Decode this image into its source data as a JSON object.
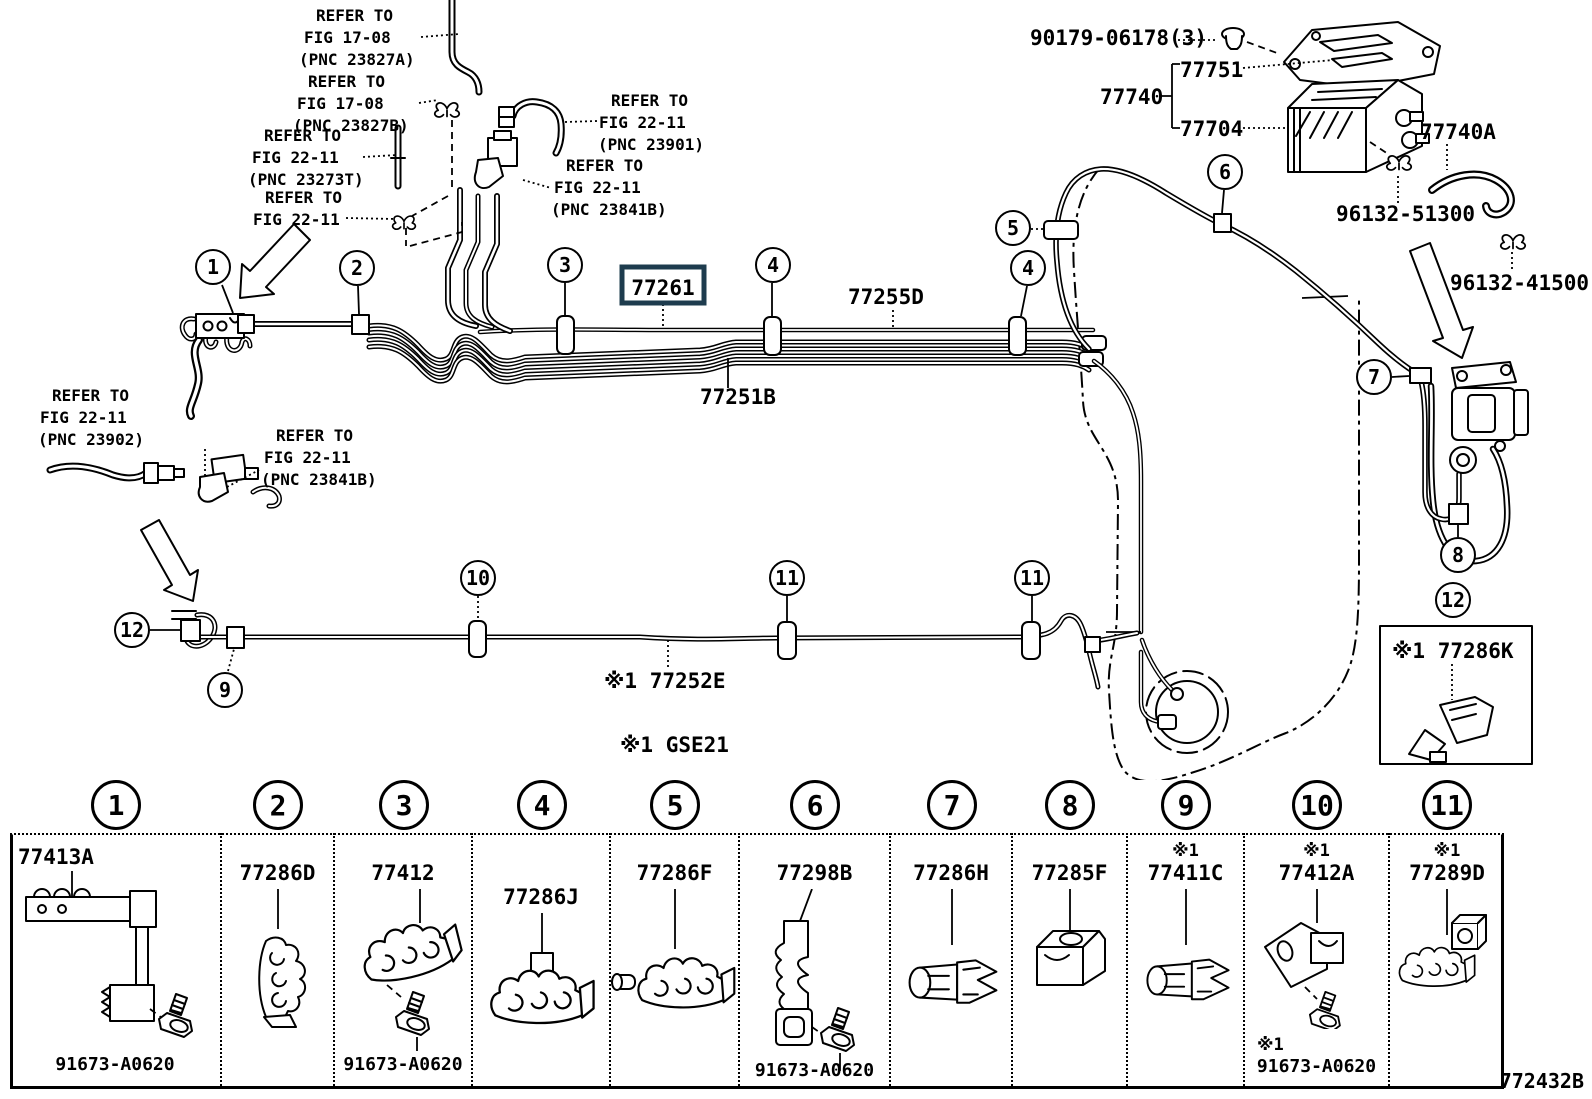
{
  "figure": {
    "code": "772432B",
    "variant_note": "※1 GSE21",
    "highlight_color": "#1e3c4e"
  },
  "refer_notes": [
    {
      "lines": [
        "REFER TO",
        "FIG 17-08",
        "(PNC 23827A)"
      ]
    },
    {
      "lines": [
        "REFER TO",
        "FIG 17-08",
        "(PNC 23827B)"
      ]
    },
    {
      "lines": [
        "REFER TO",
        "FIG 22-11",
        "(PNC 23273T)"
      ]
    },
    {
      "lines": [
        "REFER TO",
        "FIG 22-11"
      ]
    },
    {
      "lines": [
        "REFER TO",
        "FIG 22-11",
        "(PNC 23901)"
      ]
    },
    {
      "lines": [
        "REFER TO",
        "FIG 22-11",
        "(PNC 23841B)"
      ]
    },
    {
      "lines": [
        "REFER TO",
        "FIG 22-11",
        "(PNC 23902)"
      ]
    },
    {
      "lines": [
        "REFER TO",
        "FIG 22-11",
        "(PNC 23841B)"
      ]
    }
  ],
  "parts": {
    "grommet": "90179-06178(3)",
    "shield_plate": "77751",
    "canister_assy": "77740",
    "canister": "77704",
    "hose": "77740A",
    "clamp_a": "96132-51300",
    "clamp_b": "96132-41500",
    "tube_main": "77261",
    "tube_return": "77255D",
    "tube_b": "77251B",
    "tube_e": "※1 77252E",
    "clamp_k": "※1 77286K"
  },
  "callouts": [
    "1",
    "2",
    "3",
    "4",
    "5",
    "6",
    "7",
    "8",
    "9",
    "10",
    "11",
    "12"
  ],
  "legend": {
    "columns": [
      {
        "num": "1",
        "part": "77413A",
        "bolt": "91673-A0620"
      },
      {
        "num": "2",
        "part": "77286D"
      },
      {
        "num": "3",
        "part": "77412",
        "bolt": "91673-A0620"
      },
      {
        "num": "4",
        "part": "77286J"
      },
      {
        "num": "5",
        "part": "77286F"
      },
      {
        "num": "6",
        "part": "77298B",
        "bolt": "91673-A0620"
      },
      {
        "num": "7",
        "part": "77286H"
      },
      {
        "num": "8",
        "part": "77285F"
      },
      {
        "num": "9",
        "note": "※1",
        "part": "77411C"
      },
      {
        "num": "10",
        "note": "※1",
        "part": "77412A",
        "bolt_note": "※1",
        "bolt": "91673-A0620"
      },
      {
        "num": "11",
        "note": "※1",
        "part": "77289D"
      }
    ]
  }
}
